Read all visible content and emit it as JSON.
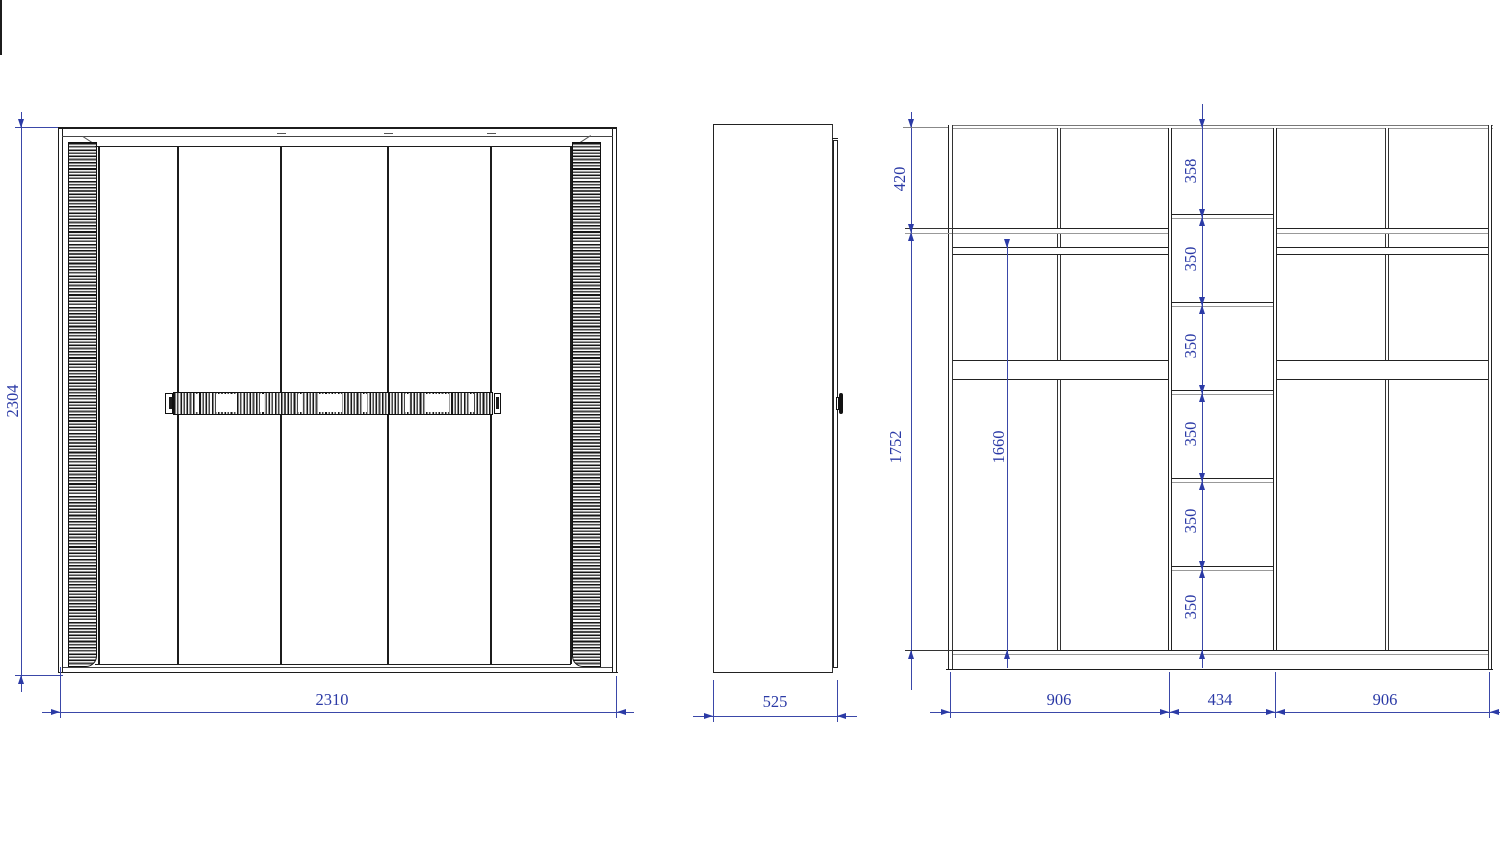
{
  "front": {
    "width_label": "2310",
    "height_label": "2304"
  },
  "side": {
    "depth_label": "525"
  },
  "interior": {
    "top_height_label": "420",
    "lower_height_label": "1752",
    "hanging_height_label": "1660",
    "section_width_labels": [
      "906",
      "434",
      "906"
    ],
    "center_cell_labels": [
      "358",
      "350",
      "350",
      "350",
      "350",
      "350"
    ]
  }
}
